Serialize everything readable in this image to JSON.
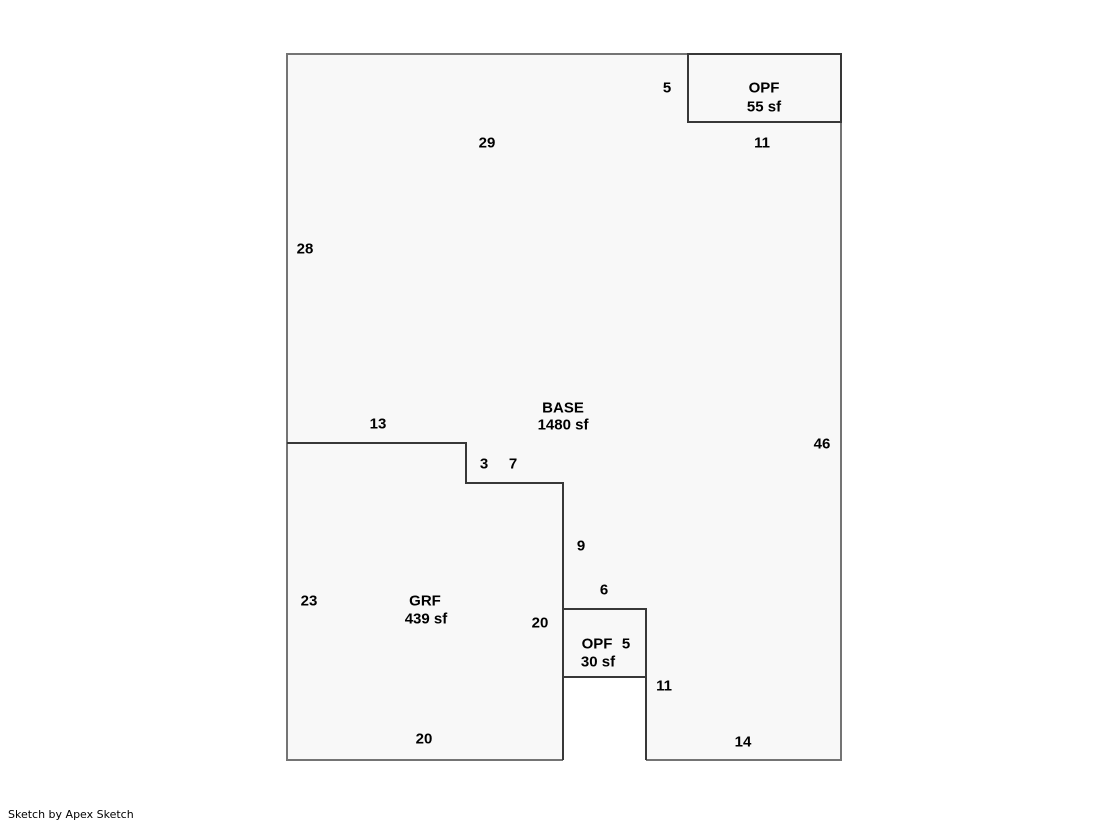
{
  "footer": {
    "credit": "Sketch by Apex Sketch"
  },
  "sketch": {
    "colors": {
      "outer_wall": "#747474",
      "inner_wall": "#383838",
      "interior_fill": "#f8f8f8",
      "background": "#ffffff",
      "label_text": "#000000"
    },
    "canvas": {
      "width": 1119,
      "height": 821
    },
    "areas": [
      {
        "name": "BASE",
        "size_label": "1480 sf",
        "dimensions_shown": [
          "29",
          "11",
          "28",
          "46",
          "13",
          "3",
          "7",
          "9",
          "6",
          "11",
          "14"
        ]
      },
      {
        "name": "GRF",
        "size_label": "439 sf",
        "dimensions_shown": [
          "13",
          "3",
          "7",
          "23",
          "20",
          "20"
        ]
      },
      {
        "name": "OPF",
        "size_label": "55 sf",
        "dimensions_shown": [
          "5",
          "11"
        ]
      },
      {
        "name": "OPF",
        "size_label": "30 sf",
        "dimensions_shown": [
          "6",
          "5",
          "11"
        ]
      }
    ],
    "fill_path": "M287,54 H841 V760 H646 V677 H563 V760 H287 Z",
    "walls": [
      {
        "role": "outer_wall",
        "d": "M563,760 H287 V54 H841 V760 H646"
      },
      {
        "role": "inner_wall",
        "d": "M287,443 H466 V483 H563 V760"
      },
      {
        "role": "inner_wall",
        "d": "M646,760 V677"
      },
      {
        "role": "inner_wall",
        "d": "M563,609 H646 V677 H563 Z"
      },
      {
        "role": "inner_wall",
        "d": "M688,54 H841 V122 H688 Z"
      }
    ],
    "labels": [
      {
        "text": "5",
        "x": 667,
        "y": 88,
        "kind": "dimension"
      },
      {
        "text": "OPF",
        "x": 764,
        "y": 88,
        "kind": "area-name"
      },
      {
        "text": "55 sf",
        "x": 764,
        "y": 107,
        "kind": "area-size"
      },
      {
        "text": "29",
        "x": 487,
        "y": 143,
        "kind": "dimension"
      },
      {
        "text": "11",
        "x": 762,
        "y": 143,
        "kind": "dimension"
      },
      {
        "text": "28",
        "x": 305,
        "y": 249,
        "kind": "dimension"
      },
      {
        "text": "BASE",
        "x": 563,
        "y": 408,
        "kind": "area-name"
      },
      {
        "text": "1480 sf",
        "x": 563,
        "y": 425,
        "kind": "area-size"
      },
      {
        "text": "13",
        "x": 378,
        "y": 424,
        "kind": "dimension"
      },
      {
        "text": "46",
        "x": 822,
        "y": 444,
        "kind": "dimension"
      },
      {
        "text": "3",
        "x": 484,
        "y": 464,
        "kind": "dimension"
      },
      {
        "text": "7",
        "x": 513,
        "y": 464,
        "kind": "dimension"
      },
      {
        "text": "9",
        "x": 581,
        "y": 546,
        "kind": "dimension"
      },
      {
        "text": "6",
        "x": 604,
        "y": 590,
        "kind": "dimension"
      },
      {
        "text": "23",
        "x": 309,
        "y": 601,
        "kind": "dimension"
      },
      {
        "text": "GRF",
        "x": 425,
        "y": 601,
        "kind": "area-name"
      },
      {
        "text": "439 sf",
        "x": 426,
        "y": 619,
        "kind": "area-size"
      },
      {
        "text": "20",
        "x": 540,
        "y": 623,
        "kind": "dimension"
      },
      {
        "text": "OPF",
        "x": 597,
        "y": 644,
        "kind": "area-name"
      },
      {
        "text": "5",
        "x": 626,
        "y": 644,
        "kind": "dimension"
      },
      {
        "text": "30 sf",
        "x": 598,
        "y": 662,
        "kind": "area-size"
      },
      {
        "text": "11",
        "x": 664,
        "y": 686,
        "kind": "dimension"
      },
      {
        "text": "20",
        "x": 424,
        "y": 739,
        "kind": "dimension"
      },
      {
        "text": "14",
        "x": 743,
        "y": 742,
        "kind": "dimension"
      }
    ],
    "label_style": {
      "font_size": 15,
      "font_weight": "bold"
    }
  }
}
